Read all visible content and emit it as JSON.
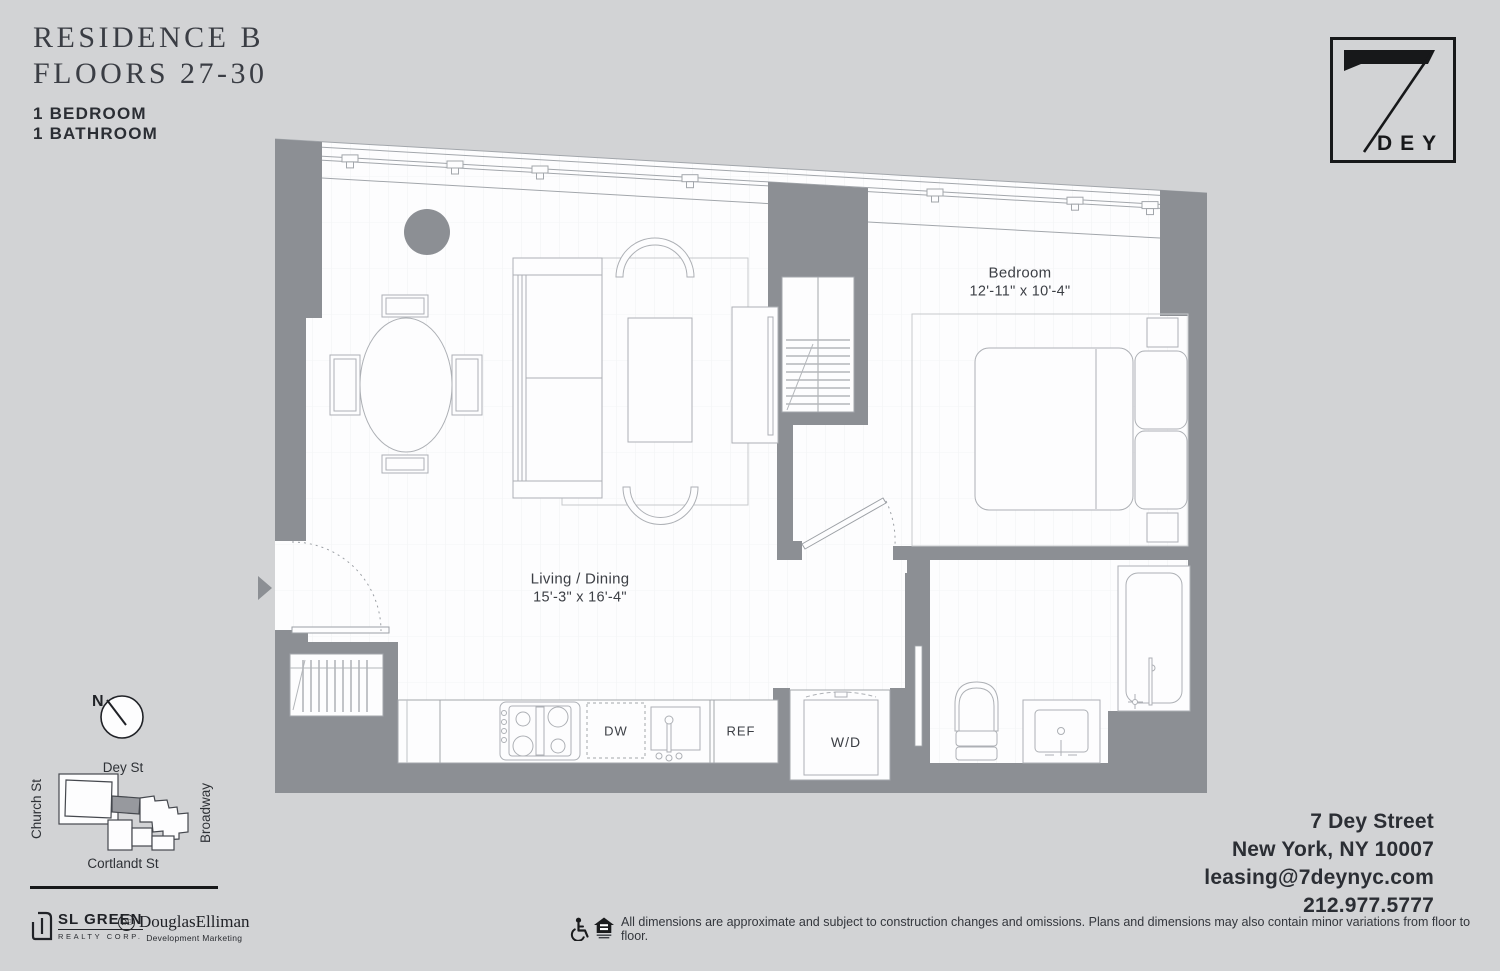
{
  "header": {
    "residence": "RESIDENCE B",
    "floors": "FLOORS 27-30",
    "bedroom": "1 BEDROOM",
    "bathroom": "1 BATHROOM"
  },
  "logo": {
    "number": "7",
    "name": "DEY"
  },
  "plan": {
    "living": {
      "name": "Living / Dining",
      "dims": "15'-3\" x 16'-4\""
    },
    "bedroom": {
      "name": "Bedroom",
      "dims": "12'-11\" x 10'-4\""
    },
    "appliances": {
      "dishwasher": "DW",
      "refrigerator": "REF",
      "washer_dryer": "W/D"
    },
    "colors": {
      "wall": "#8c8f94",
      "floor": "#fdfdfe",
      "furniture_line": "#adb0b5",
      "background": "#d2d3d5"
    }
  },
  "map": {
    "north": "N",
    "streets": {
      "top": "Dey St",
      "left": "Church St",
      "right": "Broadway",
      "bottom": "Cortlandt St"
    }
  },
  "brands": {
    "sl_green": {
      "name": "SL GREEN",
      "sub": "REALTY CORP."
    },
    "douglas_elliman": {
      "name": "DouglasElliman",
      "sub": "Development Marketing",
      "monogram": "DE"
    }
  },
  "contact": {
    "street": "7 Dey Street",
    "city": "New York, NY 10007",
    "email": "leasing@7deynyc.com",
    "phone": "212.977.5777"
  },
  "footer": {
    "disclaimer": "All dimensions are approximate and subject to construction changes and omissions. Plans and dimensions may also contain minor variations from floor to floor."
  }
}
